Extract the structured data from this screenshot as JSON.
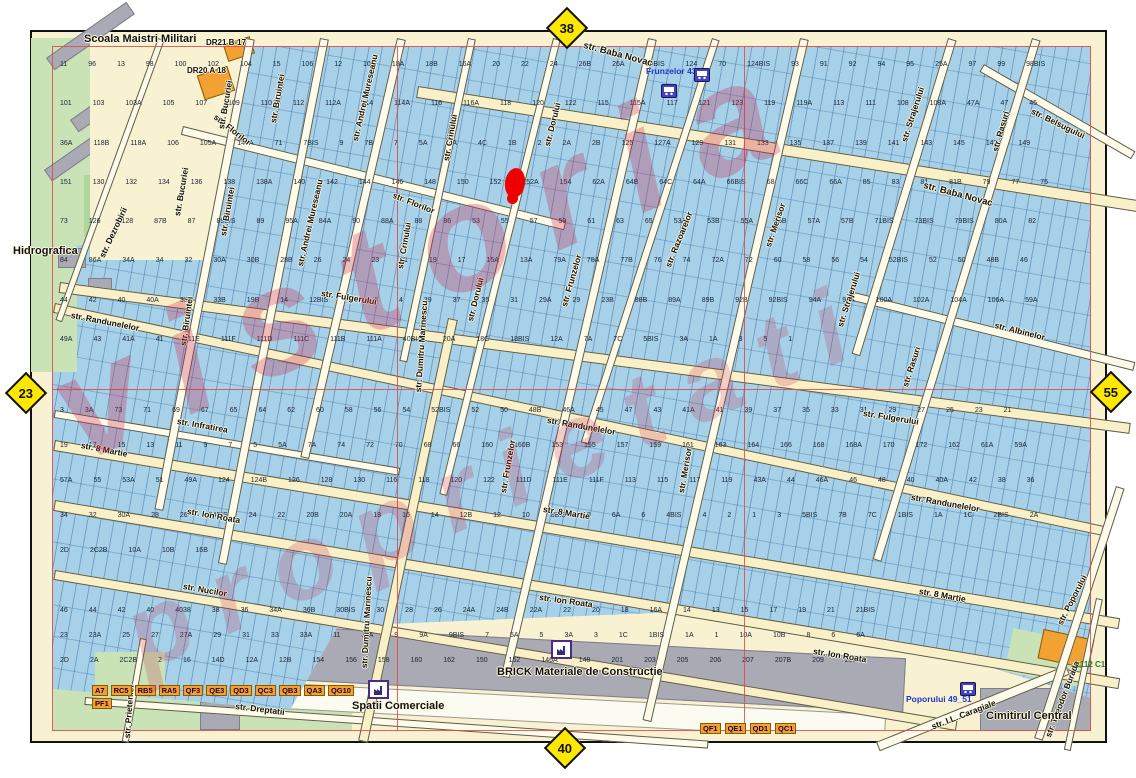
{
  "map": {
    "neighbor_pages": {
      "top": "38",
      "left": "23",
      "right": "55",
      "bottom": "40"
    },
    "watermark": {
      "line1": "vistoria",
      "line2": "proprietati"
    },
    "landmarks": {
      "school": "Scoala Maistri Militari",
      "hidrografica": "Hidrografica",
      "dr21": "DR21 B-17",
      "dr20": "DR20 A 18",
      "brick": "BRICK Materiale de Constructie",
      "spatii": "Spatii Comerciale",
      "cimitir": "Cimitirul Central",
      "l112": "L112 C1"
    },
    "transit": {
      "frunzelor": "Frunzelor 43",
      "poporului": "Poporului 49_51"
    },
    "streets": {
      "baba_novac": "str. Baba Novac",
      "florilor": "str. Florilor",
      "dezrobirii": "str. Dezrobirii",
      "bucuriei": "str. Bucuriei",
      "biruintei": "str. Biruintei",
      "andrei_muresanu": "str. Andrei Mureseanu",
      "crinului": "str. Crinului",
      "dorului": "str. Dorului",
      "frunzelor": "str. Frunzelor",
      "razoarelor": "str. Razoarelor",
      "merisor": "str. Merisor",
      "strajerului": "str. Strajerului",
      "rasuri": "str. Rasuri",
      "belsugului": "str. Belsugului",
      "albinelor": "str. Albinelor",
      "fulgerului": "str. Fulgerului",
      "randunelelor": "str. Randunelelor",
      "infratirea": "str. Infratirea",
      "opt_martie": "str. 8 Martie",
      "ion_roata": "str. Ion Roata",
      "nucilor": "str. Nucilor",
      "dreptatii": "str. Dreptatii",
      "dumitru_marinescu": "str. Dumitru Marinescu",
      "prieteniei": "str. Prieteniei",
      "poporului": "str. Poporului",
      "theodor_burada": "str. Theodor Burada",
      "caragiale": "str. I.L. Caragiale"
    },
    "building_codes": [
      "A7",
      "RC5",
      "RB5",
      "RA5",
      "QF3",
      "QE3",
      "QD3",
      "QC3",
      "QB3",
      "QA3",
      "QG10",
      "PF1"
    ],
    "building_codes2": [
      "QF1",
      "QE1",
      "QD1",
      "QC1"
    ],
    "parcels_top": [
      "11",
      "96",
      "13",
      "98",
      "100",
      "102",
      "104",
      "15",
      "106",
      "12",
      "10",
      "18A",
      "18B",
      "16A",
      "20",
      "22",
      "24",
      "26B",
      "26A",
      "25BIS",
      "124",
      "70",
      "124BIS",
      "93",
      "91",
      "92",
      "94",
      "95",
      "25A",
      "97",
      "99",
      "98BIS",
      "101",
      "103",
      "103A",
      "105",
      "107",
      "109",
      "110",
      "112",
      "112A",
      "114",
      "114A",
      "116",
      "116A",
      "118",
      "120",
      "122",
      "115",
      "115A",
      "117",
      "121",
      "123",
      "119",
      "119A",
      "113",
      "111",
      "108",
      "108A",
      "47A",
      "47",
      "45",
      "36A",
      "118B",
      "118A",
      "106",
      "105A",
      "144A",
      "71",
      "7BIS",
      "9",
      "7B",
      "7",
      "5A",
      "4A",
      "4C",
      "1B",
      "2",
      "2A",
      "2B",
      "125",
      "127A",
      "129",
      "131",
      "133",
      "135",
      "137",
      "139",
      "141",
      "143",
      "145",
      "147",
      "149",
      "151",
      "130",
      "132",
      "134",
      "136",
      "138",
      "138A",
      "140",
      "142",
      "144",
      "146",
      "148",
      "150",
      "152",
      "152A",
      "154",
      "62A",
      "64B",
      "64C",
      "64A",
      "66BIS",
      "68",
      "66C",
      "66A",
      "85",
      "83",
      "81",
      "81B",
      "79",
      "77",
      "75",
      "73",
      "126",
      "128",
      "87B",
      "87",
      "89BIS",
      "89",
      "95A",
      "84A",
      "90",
      "88A",
      "88",
      "86",
      "53",
      "55",
      "57",
      "59",
      "61",
      "63",
      "65",
      "53A",
      "53B",
      "55A",
      "55B",
      "57A",
      "57B",
      "71BIS",
      "73BIS",
      "79BIS",
      "80A",
      "82",
      "84",
      "86A",
      "34A",
      "34",
      "32",
      "30A",
      "30B",
      "28B",
      "26",
      "24",
      "23",
      "21",
      "19",
      "17",
      "15A",
      "13A",
      "79A",
      "78A",
      "77B",
      "76",
      "74",
      "72A",
      "72",
      "60",
      "58",
      "56",
      "54",
      "52BIS",
      "52",
      "50",
      "48B",
      "46",
      "44",
      "42",
      "40",
      "40A",
      "33A",
      "33B",
      "19B",
      "14",
      "12BIS",
      "8",
      "6",
      "4",
      "39",
      "37",
      "35",
      "31",
      "29A",
      "29",
      "23B",
      "88B",
      "89A",
      "89B",
      "92B",
      "92BIS",
      "94A",
      "96A",
      "100A",
      "102A",
      "104A",
      "106A",
      "59A",
      "49A",
      "43",
      "41A",
      "41",
      "111E",
      "111F",
      "111D",
      "111C",
      "111B",
      "111A",
      "40BIS",
      "20A",
      "18C",
      "18BIS",
      "12A",
      "7A",
      "7C",
      "5BIS",
      "3A",
      "1A",
      "3",
      "5",
      "1"
    ],
    "parcels_mid": [
      "3",
      "3A",
      "73",
      "71",
      "69",
      "67",
      "65",
      "64",
      "62",
      "60",
      "58",
      "56",
      "54",
      "52BIS",
      "52",
      "50",
      "48B",
      "46A",
      "45",
      "47",
      "43",
      "41A",
      "41",
      "39",
      "37",
      "35",
      "33",
      "31",
      "29",
      "27",
      "25",
      "23",
      "21",
      "19",
      "17",
      "15",
      "13",
      "11",
      "9",
      "7",
      "5",
      "5A",
      "7A",
      "74",
      "72",
      "70",
      "68",
      "66",
      "160",
      "160B",
      "153",
      "155",
      "157",
      "159",
      "161",
      "163",
      "164",
      "166",
      "168",
      "168A",
      "170",
      "172",
      "162",
      "61A",
      "59A",
      "57A",
      "55",
      "53A",
      "51",
      "49A",
      "124",
      "124B",
      "126",
      "128",
      "130",
      "116",
      "118",
      "120",
      "122",
      "111D",
      "111E",
      "111F",
      "113",
      "115",
      "117",
      "119",
      "43A",
      "44",
      "46A",
      "46",
      "48",
      "40",
      "40A",
      "42",
      "38",
      "36",
      "34",
      "32",
      "30A",
      "28",
      "26",
      "24BIS",
      "24",
      "22",
      "20B",
      "20A",
      "18",
      "16",
      "14",
      "12B",
      "12",
      "10",
      "8BIS",
      "8",
      "6A",
      "6",
      "4BIS",
      "4",
      "2",
      "1",
      "3",
      "5BIS",
      "7B",
      "7C",
      "1BIS",
      "1A",
      "1C",
      "2BIS",
      "2A",
      "2D",
      "2C2B",
      "10A",
      "10B",
      "16B"
    ],
    "parcels_bottom": [
      "46",
      "44",
      "42",
      "40",
      "4038",
      "38",
      "36",
      "34A",
      "36B",
      "30BIS",
      "30",
      "28",
      "26",
      "24A",
      "24B",
      "22A",
      "22",
      "20",
      "18",
      "16A",
      "14",
      "13",
      "15",
      "17",
      "19",
      "21",
      "21BIS",
      "23",
      "23A",
      "25",
      "27",
      "27A",
      "29",
      "31",
      "33",
      "33A",
      "11",
      "11A",
      "9",
      "9A",
      "9BIS",
      "7",
      "5A",
      "5",
      "3A",
      "3",
      "1C",
      "1BIS",
      "1A",
      "1",
      "10A",
      "10B",
      "8",
      "6",
      "6A",
      "2D",
      "2A",
      "2C2B",
      "2",
      "16",
      "14D",
      "12A",
      "12B",
      "154",
      "156",
      "158",
      "160",
      "162",
      "150",
      "152",
      "146A",
      "148",
      "201",
      "203",
      "205",
      "206",
      "207",
      "207B",
      "209",
      "209A",
      "45A",
      "60",
      "58",
      "2BIS",
      "4",
      "4A",
      "8,8A",
      "10",
      "12",
      "19,19A",
      "17A",
      "13BIS",
      "15A",
      "21A",
      "22BIS",
      "25A"
    ]
  }
}
